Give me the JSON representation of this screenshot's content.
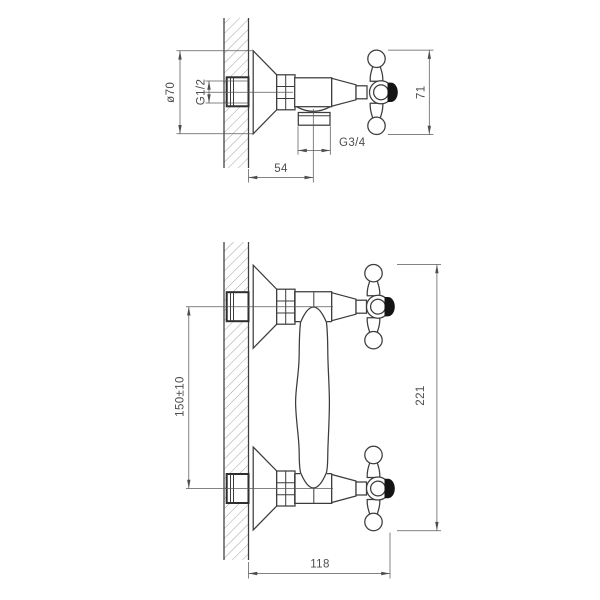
{
  "drawing": {
    "title_hint": "wall-mounted mixer installation drawing",
    "background": "#ffffff",
    "line_color": "#3c3c3c",
    "dim_color": "#4d4d4d",
    "top_view": {
      "dim_escutcheon_diameter": "ø70",
      "dim_inlet_thread": "G1/2",
      "dim_outlet_thread": "G3/4",
      "dim_wall_to_outlet": "54",
      "dim_handle_height": "71"
    },
    "bottom_view": {
      "dim_inlet_spacing": "150±10",
      "dim_overall_height": "221",
      "dim_projection": "118"
    }
  }
}
